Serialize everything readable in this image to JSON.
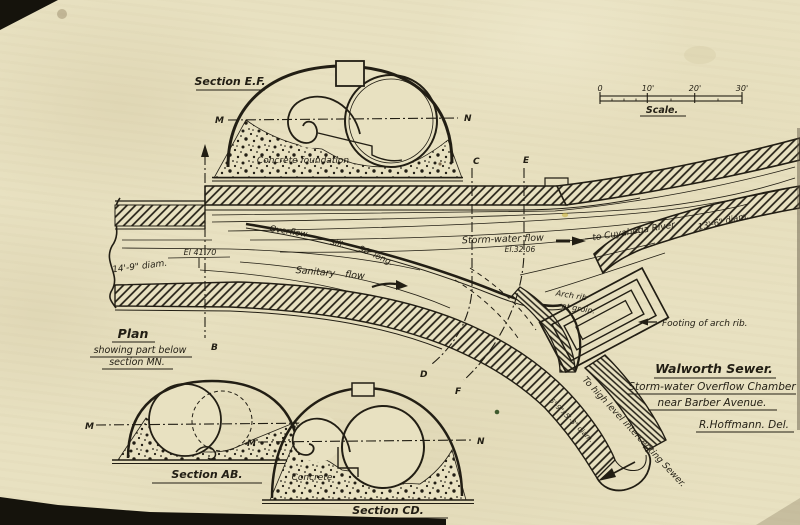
{
  "page": {
    "bg": "#e8e1c1",
    "ink": "#221e14"
  },
  "scale_bar": {
    "tick0": "0",
    "tick1": "10'",
    "tick2": "20'",
    "tick3": "30'",
    "label": "Scale."
  },
  "section_ef": {
    "title": "Section E.F.",
    "foundation_label": "Concrete foundation",
    "m": "M",
    "n": "N"
  },
  "section_ab": {
    "title": "Section AB.",
    "m": "M",
    "n": "N"
  },
  "section_cd": {
    "title": "Section CD.",
    "concrete_label": "Concrete",
    "m": "M",
    "n": "N"
  },
  "plan": {
    "title": "Plan",
    "subtitle1": "showing part below",
    "subtitle2": "section MN.",
    "overflow_word": "Overflow",
    "sill_word": "sill.",
    "sill_length": "90' long.",
    "sanitary_flow": "Sanitary flow",
    "storm_water_flow": "Storm-water flow",
    "storm_elevation": "El.32.06",
    "to_river": "to Cuyahoga River",
    "right_diam": "13'-6\" diam.",
    "left_diam": "14'-9\" diam.",
    "left_elevation": "El 41.70",
    "arch_rib_1": "Arch rib",
    "arch_rib_2": "at groin.",
    "footing_label": "Footing of arch rib.",
    "intercepting_label": "To high level intercepting Sewer.",
    "branch_diam": "5'-9\"x5'-3\" diam.",
    "letter_b": "B",
    "letter_c": "C",
    "letter_d": "D",
    "letter_e": "E",
    "letter_f": "F"
  },
  "title_block": {
    "line1": "Walworth Sewer.",
    "line2": "Storm-water Overflow Chamber",
    "line3": "near Barber Avenue.",
    "credit": "R.Hoffmann.  Del."
  }
}
